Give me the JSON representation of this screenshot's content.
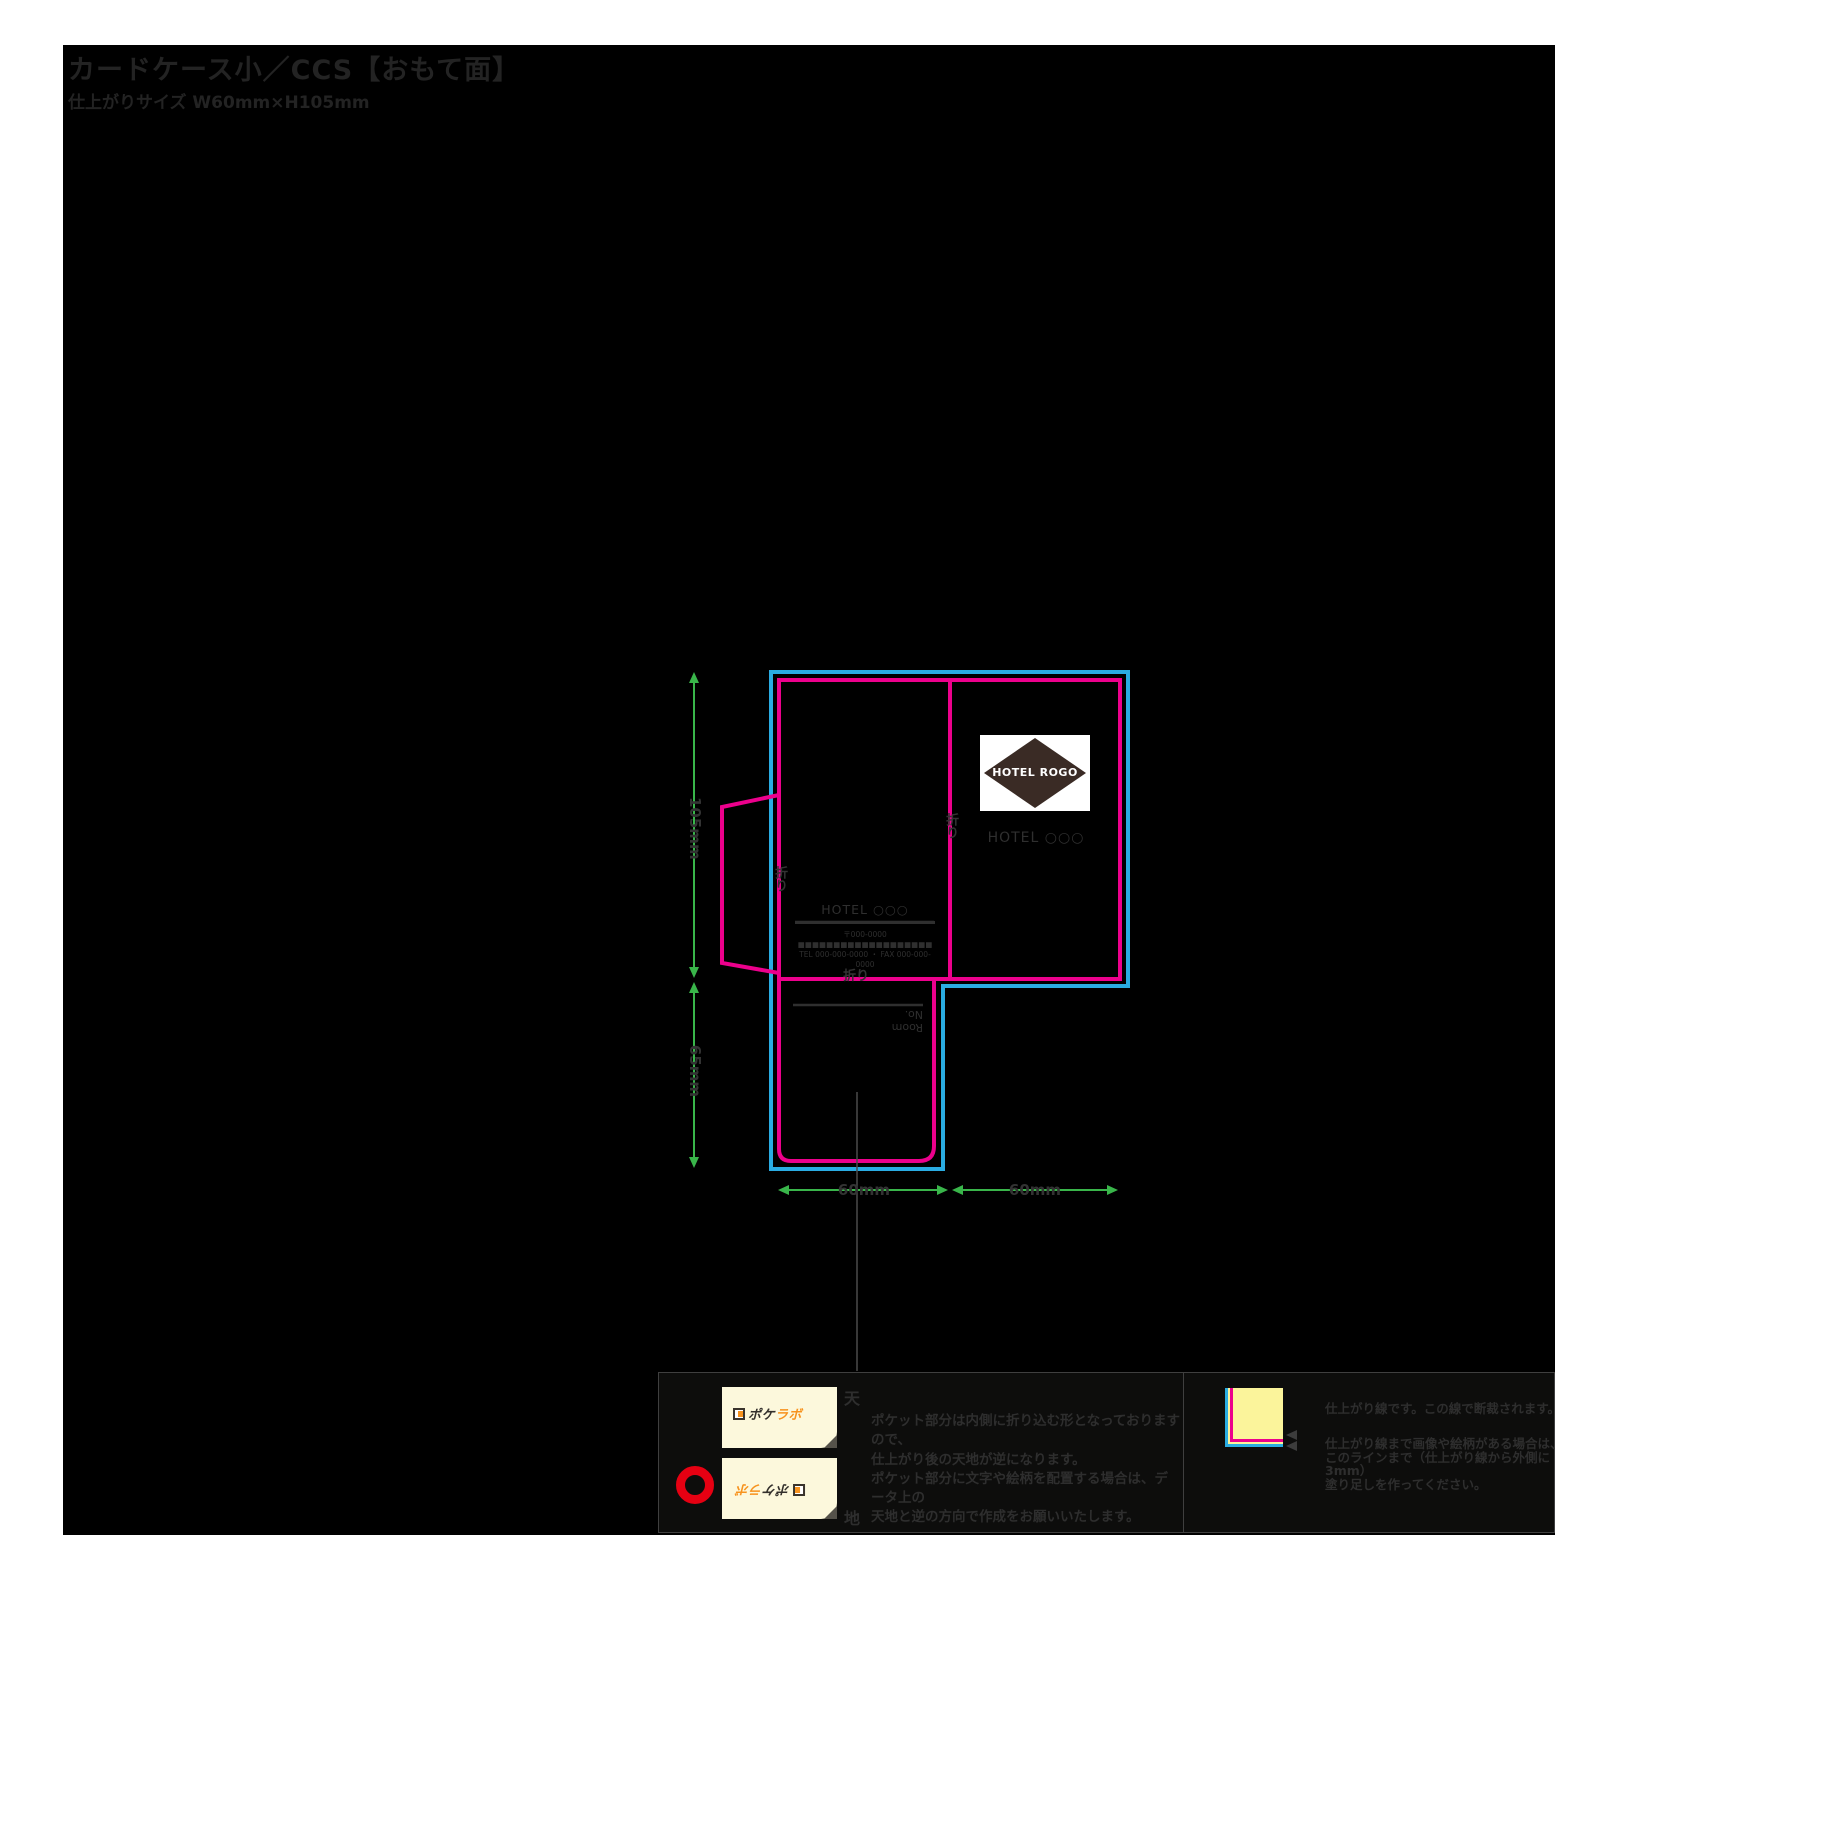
{
  "page": {
    "title": "カードケース小／CCS【おもて面】",
    "subtitle": "仕上がりサイズ W60mm×H105mm"
  },
  "colors": {
    "bleed_cut_line_cyan": "#2aace2",
    "finish_line_magenta": "#ec008c",
    "dimension_green": "#39b54a",
    "artboard_black": "#000000",
    "red_circle": "#e60012",
    "logo_orange": "#f7931e",
    "card_cream": "#fcf8dc",
    "legend_yellow": "#fbf49b"
  },
  "template": {
    "logo_diamond_text": "HOTEL ROGO",
    "hotel_front_text": "HOTEL ○○○",
    "back_block": {
      "hotel": "HOTEL ○○○",
      "address": "〒000-0000 ■■■■■■■■■■■■■■■■■■■",
      "tel": "TEL 000-000-0000 ・ FAX 000-000-0000"
    },
    "pocket_room_no": "Room No.",
    "fold_label_center": "折り",
    "fold_label_flap": "折り",
    "fold_label_pocket": "折り",
    "dimensions": {
      "upper_height": "105mm",
      "pocket_height": "65mm",
      "left_width": "60mm",
      "right_width": "60mm"
    }
  },
  "notes_left": {
    "sample_logo_dark": "ポケ",
    "sample_logo_orange": "ラボ",
    "top_label": "天",
    "bottom_label": "地",
    "lines": [
      "ポケット部分は内側に折り込む形となっておりますので、",
      "仕上がり後の天地が逆になります。",
      "ポケット部分に文字や絵柄を配置する場合は、データ上の",
      "天地と逆の方向で作成をお願いいたします。"
    ]
  },
  "notes_right": {
    "finish_note": "仕上がり線です。この線で断裁されます。",
    "bleed_note_lines": [
      "仕上がり線まで画像や絵柄がある場合は、",
      "このラインまで（仕上がり線から外側に3mm）",
      "塗り足しを作ってください。"
    ]
  }
}
